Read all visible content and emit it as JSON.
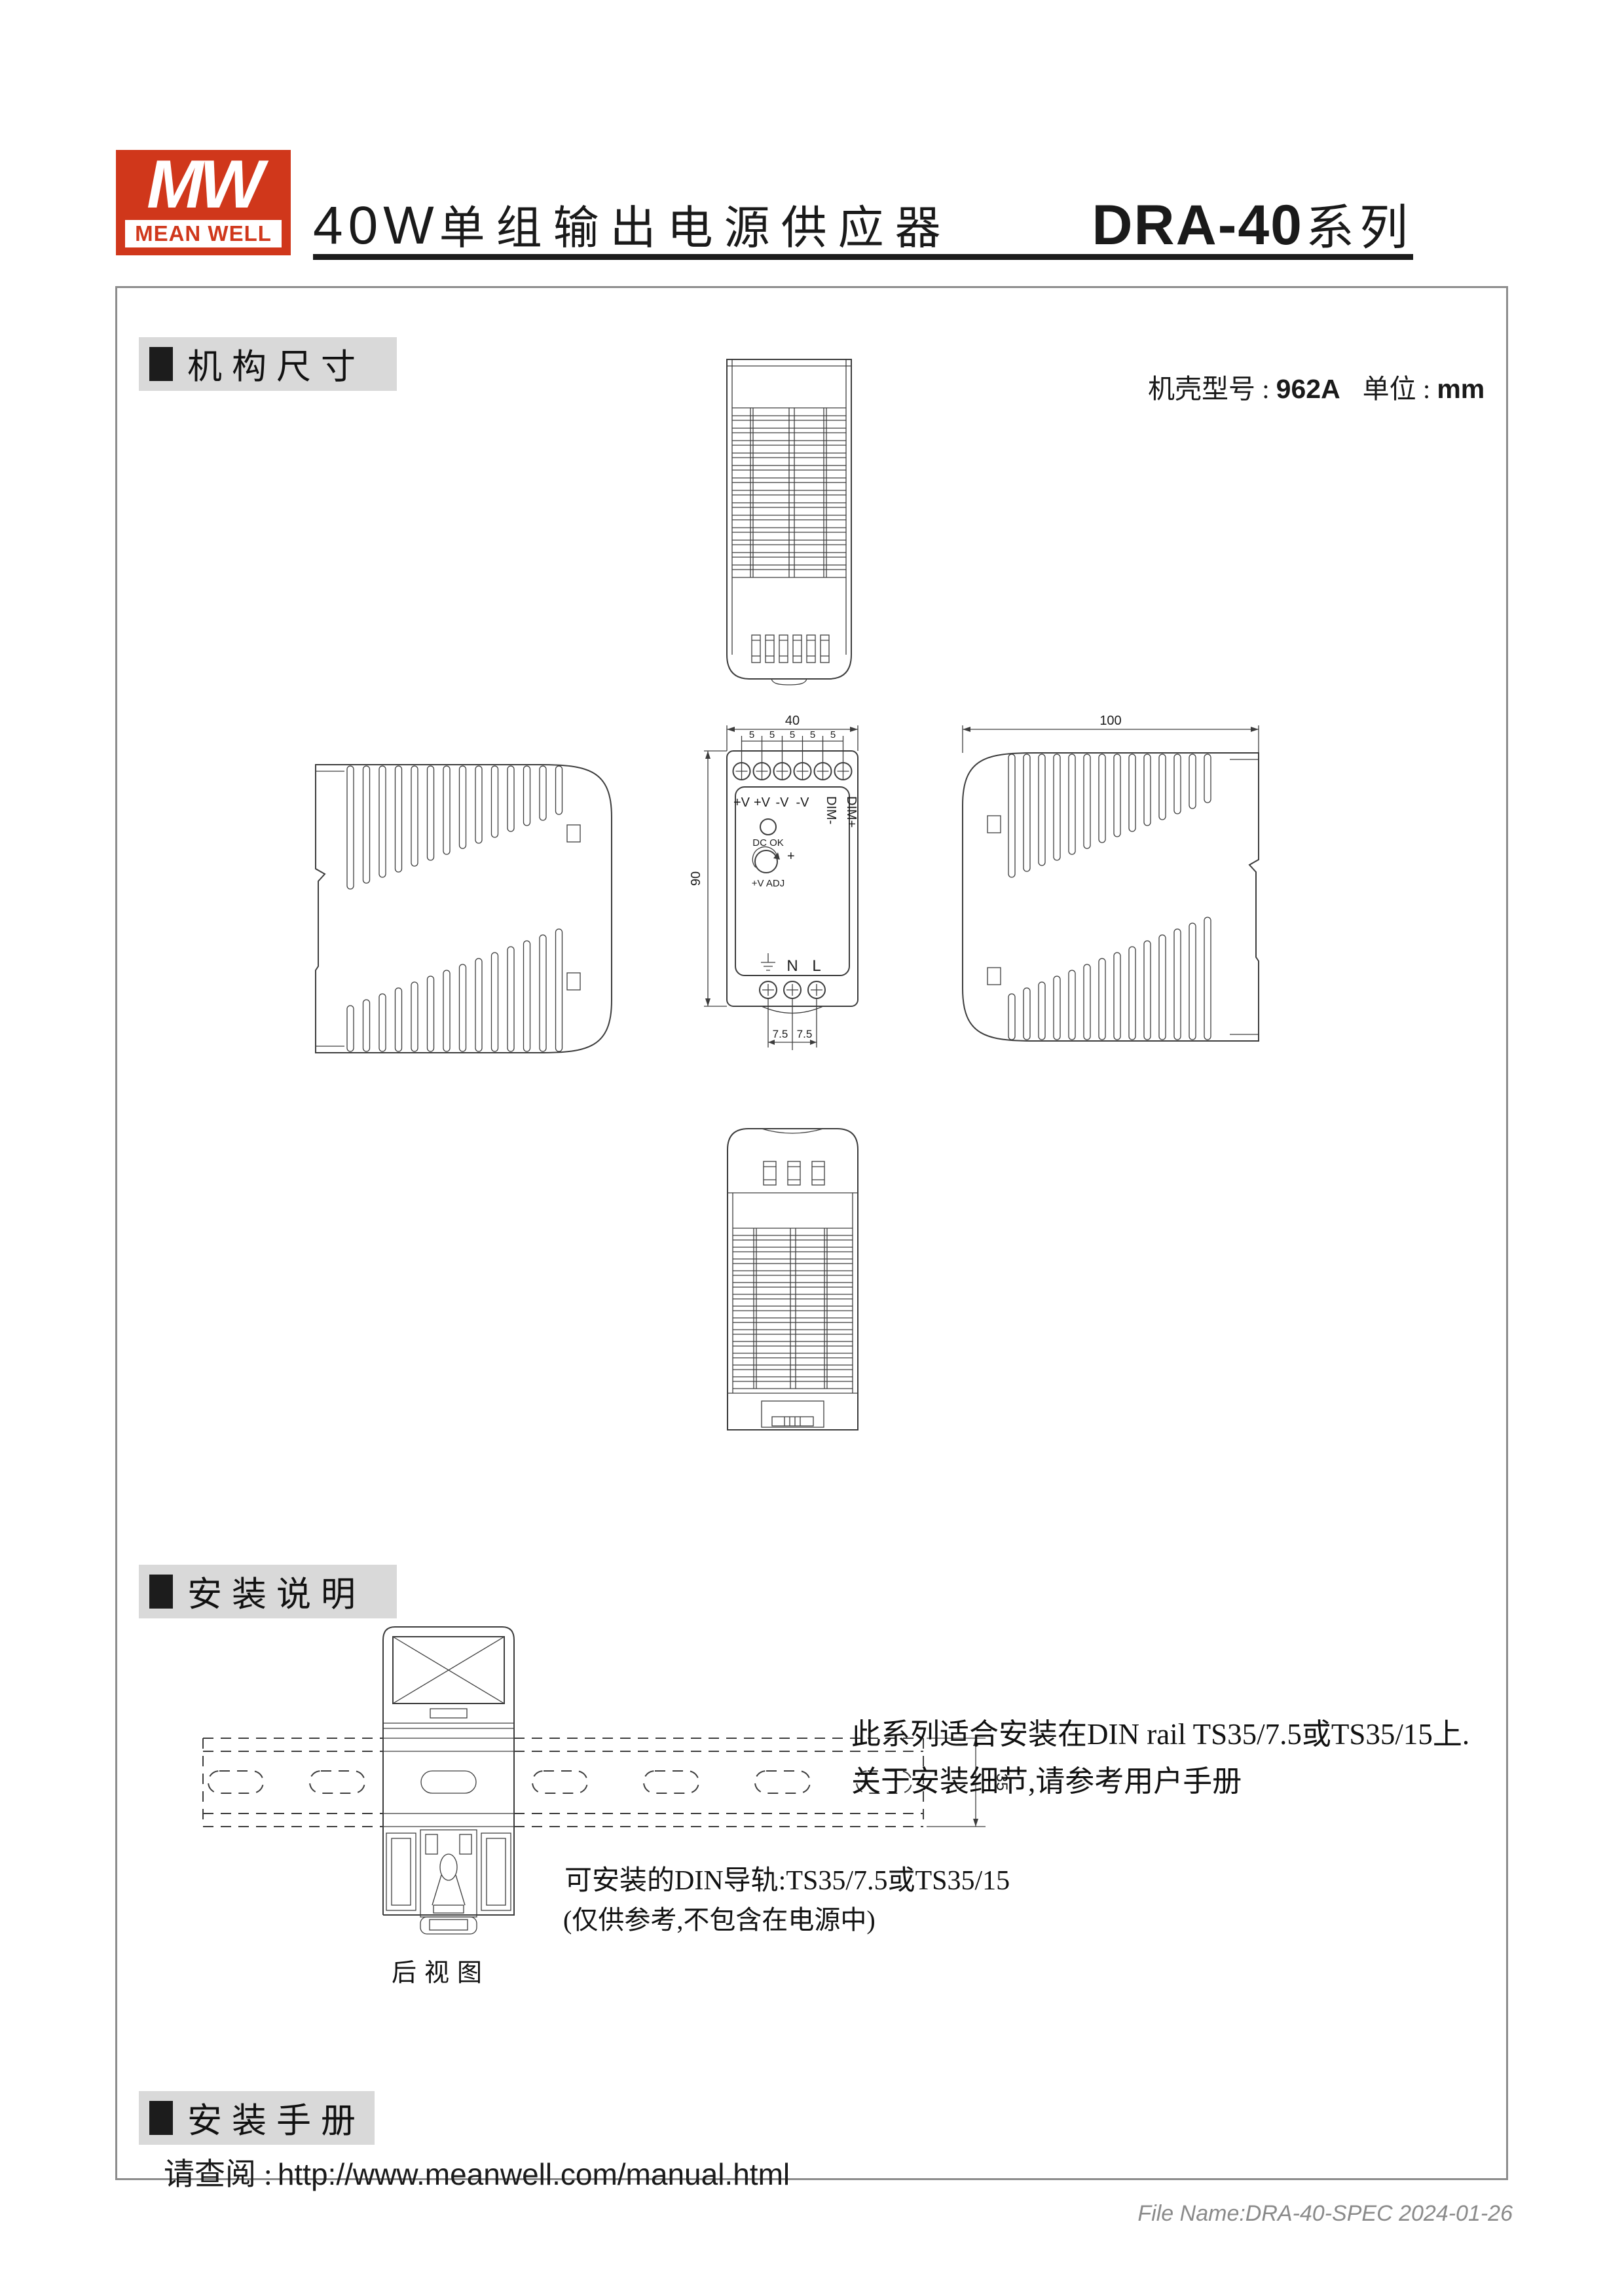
{
  "header": {
    "logo_mw": "MW",
    "logo_name": "MEAN WELL",
    "title_prefix": "40W",
    "title_cjk": "单组输出电源供应器",
    "series_model": "DRA-40",
    "series_suffix": "系列"
  },
  "sections": {
    "mech_title": "机构尺寸",
    "install_title": "安装说明",
    "manual_title": "安装手册"
  },
  "mech": {
    "case_label": "机壳型号 :",
    "case_value": "962A",
    "unit_label": "单位 :",
    "unit_value": "mm",
    "dim_width": "40",
    "dim_pitch": "5",
    "dim_height": "90",
    "dim_depth": "100",
    "dim_bottom_pitch": "7.5",
    "out_labels": [
      "+V",
      "+V",
      "-V",
      "-V",
      "DIM-",
      "DIM+"
    ],
    "led_label": "DC OK",
    "adj_label": "+V ADJ",
    "adj_plus": "+",
    "ac_labels": [
      "N",
      "L"
    ]
  },
  "install": {
    "note_line1": "此系列适合安装在DIN rail TS35/7.5或TS35/15上.",
    "note_line2": "关于安装细节,请参考用户手册",
    "rail_dim": "35",
    "rail_note1": "可安装的DIN导轨:TS35/7.5或TS35/15",
    "rail_note2": "(仅供参考,不包含在电源中)",
    "rear_view_label": "后视图"
  },
  "manual": {
    "prompt": "请查阅 :",
    "url": "http://www.meanwell.com/manual.html"
  },
  "footer": {
    "file_info": "File Name:DRA-40-SPEC  2024-01-26"
  },
  "colors": {
    "brand_red": "#d0371b",
    "line": "#3c3c3c",
    "section_bg": "#d9d9d9"
  }
}
